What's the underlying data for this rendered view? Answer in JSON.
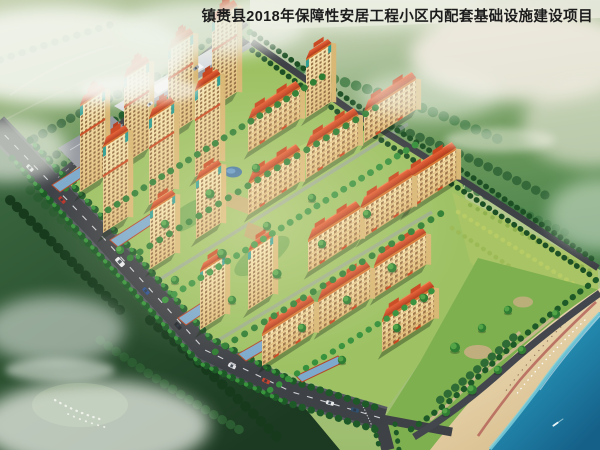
{
  "title": {
    "text": "镇赉县2018年保障性安居工程小区内配套基础设施建设项目"
  },
  "scene": {
    "kind": "aerial architectural rendering of residential community beside a lake",
    "palette": {
      "title_text": "#1c1c1c",
      "sky_mist": "#e3e7da",
      "hills_sage": "#a9bf8e",
      "forest_dark": "#24472b",
      "forest_mid": "#417f42",
      "tree_bright": "#3a9a3e",
      "estate_lawn": "#9dc163",
      "road_asphalt": "#3e4146",
      "road_marking": "#e8eaec",
      "facade_cream": "#f2dfa6",
      "facade_trim_orange": "#d8742f",
      "roof_red": "#d04a26",
      "tower_accent_teal": "#2f9e93",
      "podium_roof_blue": "#7ca9cc",
      "perimeter_trim_red": "#b5482a",
      "commercial_roof_light": "#d9dce0",
      "commercial_roof_dark": "#2e3138",
      "orchard_green": "#a9c465",
      "park_green": "#7fb050",
      "path_tan": "#cdb791",
      "sand": "#ead8b2",
      "beach_trail_red": "#b5655a",
      "water_deep": "#1b7ba3",
      "water_shallow": "#7fd2de",
      "pond_blue": "#3a6f9e",
      "mist_white": "#f3f5ef"
    }
  }
}
